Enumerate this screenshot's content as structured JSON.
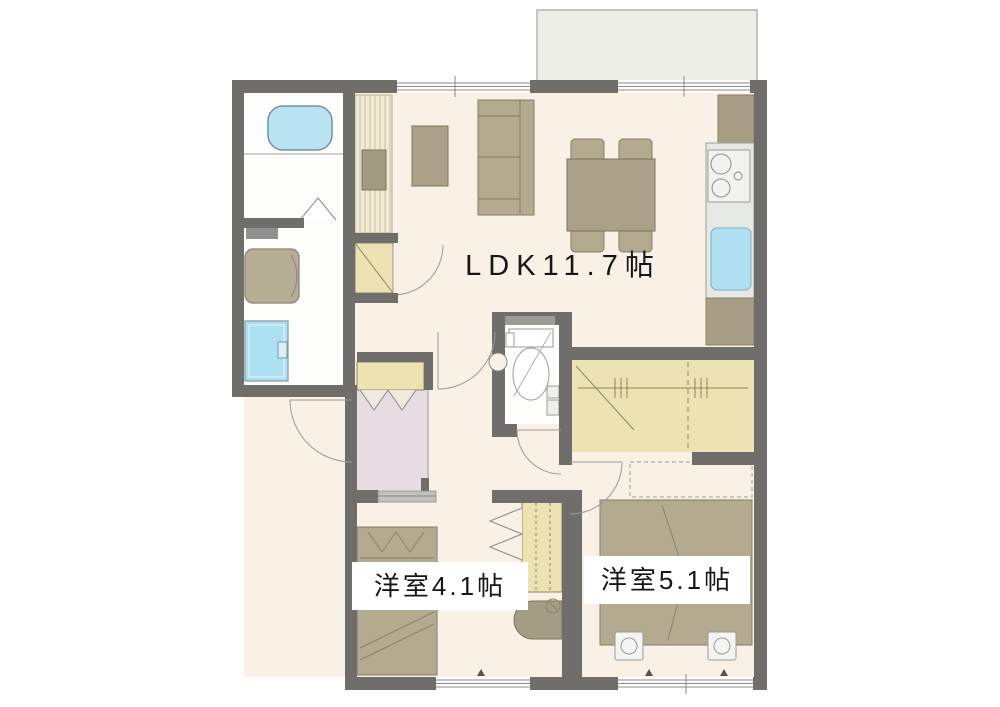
{
  "plan": {
    "title": "2LDK apartment floor plan",
    "rooms": {
      "ldk": {
        "label": "LDK11.7帖"
      },
      "bedroom_a": {
        "label": "洋室4.1帖"
      },
      "bedroom_b": {
        "label": "洋室5.1帖"
      }
    },
    "fixtures": [
      "bathtub",
      "bathroom-folding-door",
      "washing-machine",
      "vanity-sink",
      "shelf",
      "toilet",
      "toilet-door",
      "entrance-door",
      "shoe-cabinet",
      "genkan-floor",
      "tv-board",
      "coffee-table",
      "sofa",
      "dining-table",
      "dining-chairs",
      "refrigerator-space",
      "kitchen-counter",
      "gas-stove",
      "kitchen-sink",
      "kitchen-cabinet",
      "walk-in-closet",
      "closet",
      "folding-closet-door",
      "sliding-door",
      "single-bed",
      "double-bed",
      "bed-casters",
      "desk",
      "balcony",
      "windows"
    ],
    "colors": {
      "wall": "#6f6e6b",
      "floor": "#f9f0e6",
      "closet_tan": "#ece2b2",
      "furniture_tan": "#b3aa90",
      "water_blue": "#aee0f2",
      "genkan_pink": "#e7dce2",
      "balcony_gray": "#edeee8"
    }
  }
}
